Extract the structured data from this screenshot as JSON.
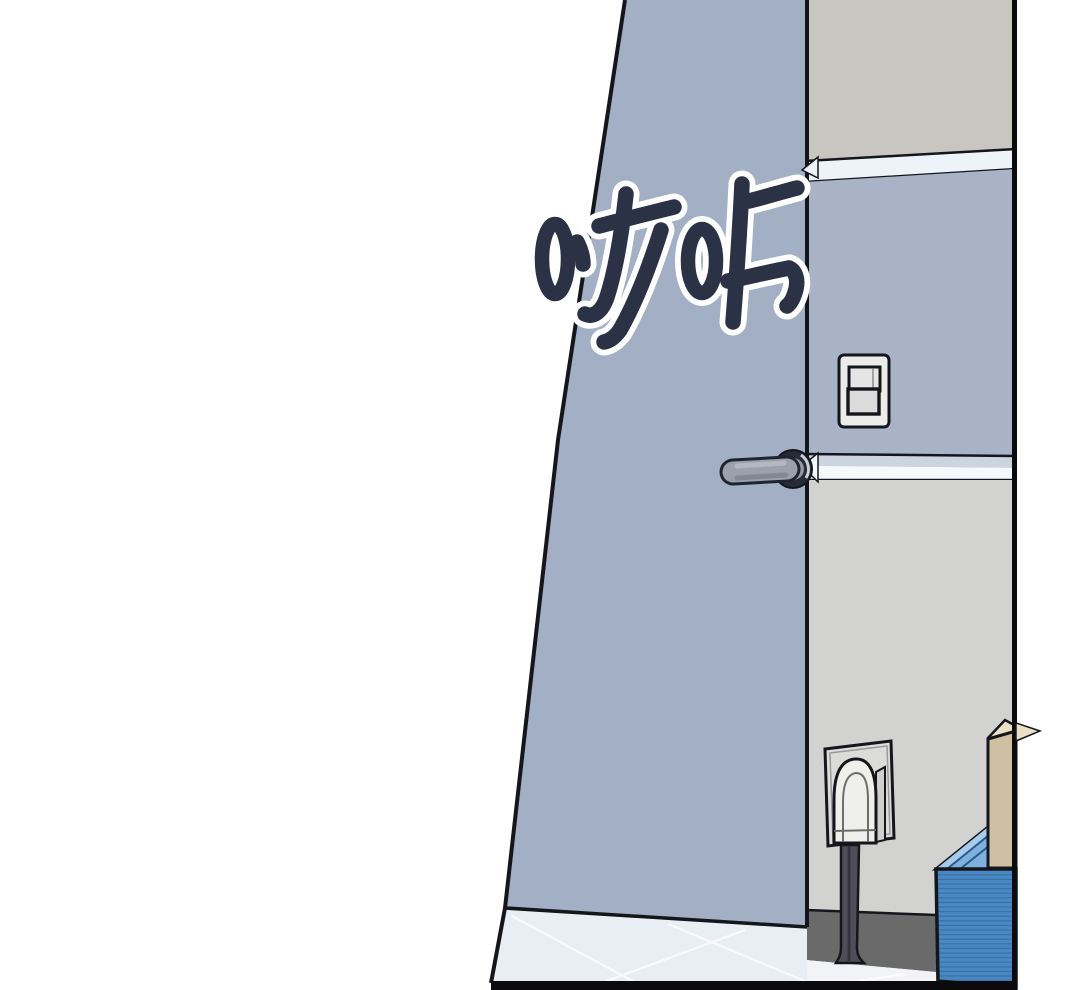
{
  "panel": {
    "kind": "comic-panel",
    "background": "#ffffff"
  },
  "sfx": {
    "text": "哒咔"
  },
  "colors": {
    "line": "#15161c",
    "border": "#0b0b0e",
    "door": "#a3afc4",
    "wall_upper": "#c8c6c1",
    "wall_mid": "#a8b3c8",
    "wall_lower": "#d2d2d0",
    "trim_light": "#eef3fa",
    "trim_blue": "#ccd4e0",
    "trim_white": "#f6f9fc",
    "baseboard": "#6a6a6a",
    "floor": "#e9edf4",
    "floor_strip": "#f1f3f7",
    "tile_line": "#ffffff",
    "switch_plate": "#ececeb",
    "switch_rocker_top": "#e4e5e4",
    "switch_rocker_bottom": "#dadbda",
    "outlet_plate": "#dcdcda",
    "plug": "#efefec",
    "plug_side": "#cfcfcb",
    "cable": "#504d5a",
    "cable_core": "#34323e",
    "handle": "#9aa1ad",
    "handle_outline": "#1e2430",
    "rosette": "#262b37",
    "rosette_center": "#9099a5",
    "stack_front": "#4a88c4",
    "stack_stripe": "#3a72a6",
    "stack_top": "#7eb1de",
    "stack_top_light": "#a6cbeb",
    "board_face": "#cfc0a3",
    "board_top": "#ebe0c6",
    "sfx_fill": "#2c3245",
    "sfx_outline": "#ffffff"
  }
}
